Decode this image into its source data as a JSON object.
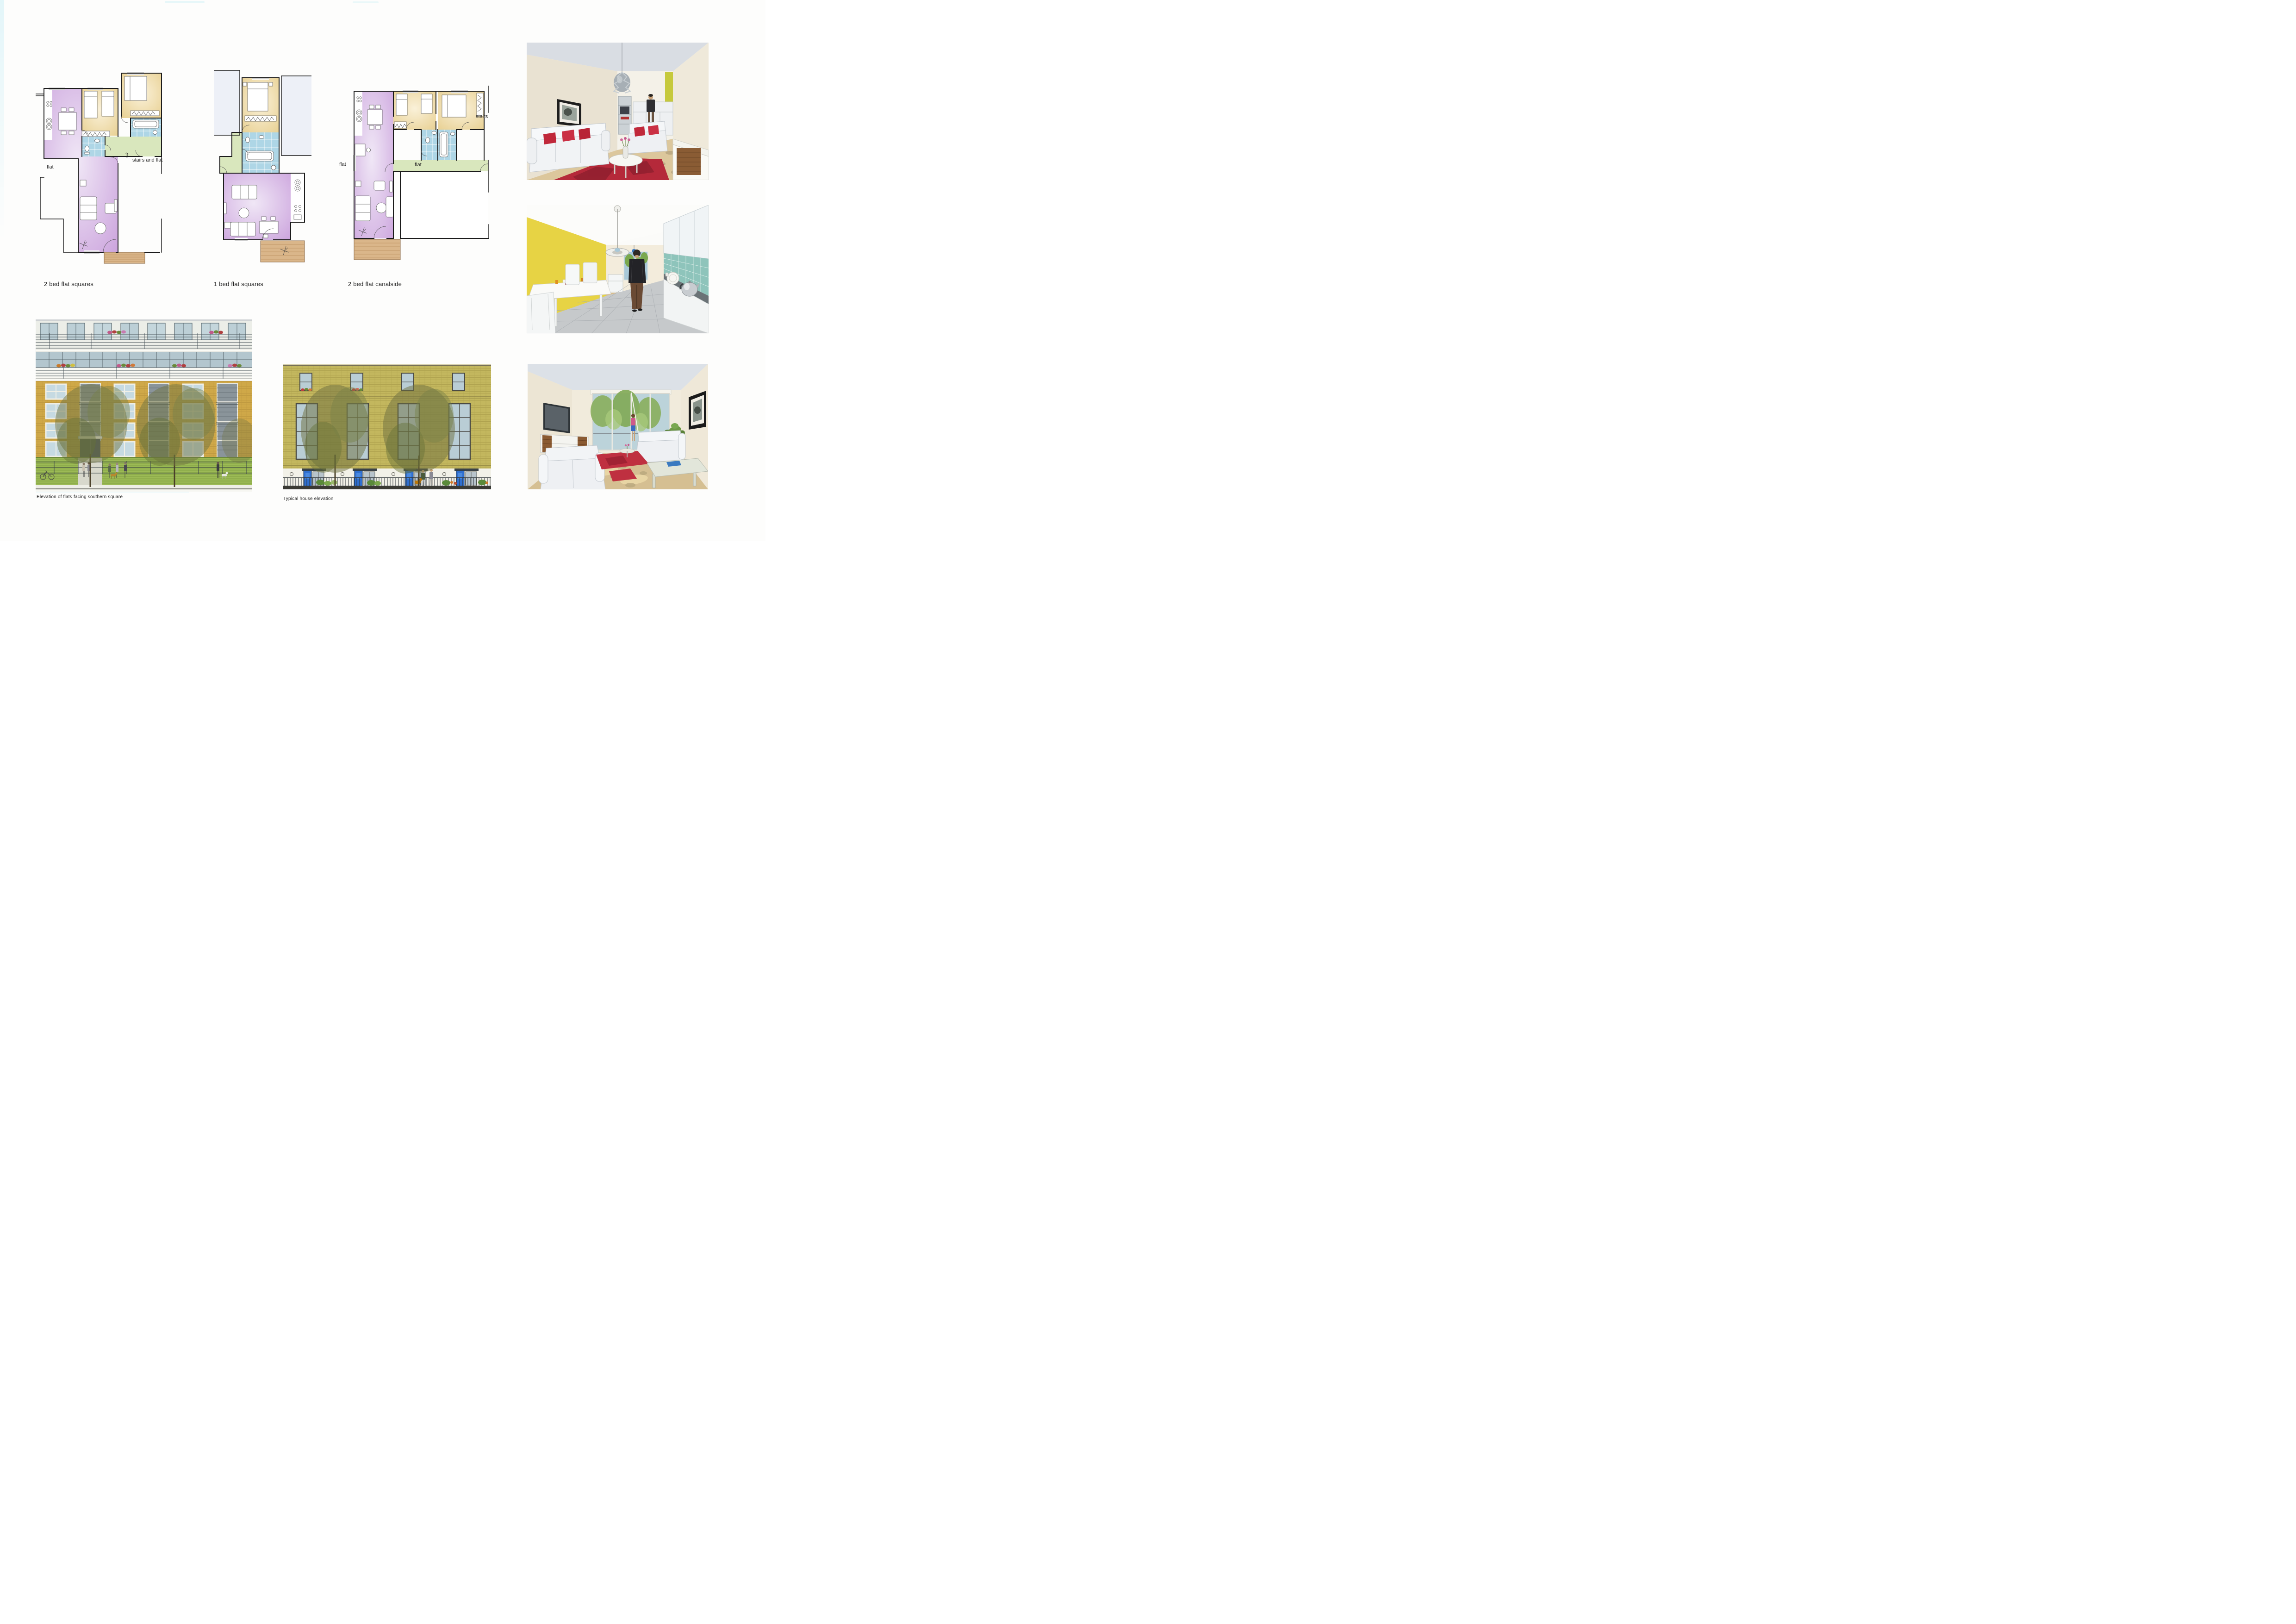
{
  "plans": {
    "two_bed_squares": {
      "caption": "2 bed flat squares",
      "labels": {
        "flat": "flat",
        "stairs_and_flat": "stairs and flat"
      }
    },
    "one_bed_squares": {
      "caption": "1 bed flat squares"
    },
    "two_bed_canalside": {
      "caption": "2 bed flat canalside",
      "labels": {
        "flat_left": "flat",
        "flat_right": "flat",
        "stairs": "stairs"
      }
    }
  },
  "elevations": {
    "flats_southern_square": {
      "caption": "Elevation of flats facing southern square"
    },
    "typical_house": {
      "caption": "Typical house elevation"
    }
  },
  "icons": {
    "up_arrow": "⇧"
  },
  "colors": {
    "plan_living_purple": "#d6b5e5",
    "plan_bedroom_tan": "#eed9a6",
    "plan_bathroom_blue": "#aed6e6",
    "plan_hall_green": "#d9e7bd",
    "plan_deck_wood": "#dab68a",
    "elevation_brick_ochre": "#cfa848",
    "elevation_brick_khaki": "#c3b75e",
    "elevation_door_blue": "#2f6fd0",
    "render_rug_red": "#b5293a",
    "render_wall_yellow": "#e7d344",
    "render_tile_teal": "#8ec4bb"
  }
}
